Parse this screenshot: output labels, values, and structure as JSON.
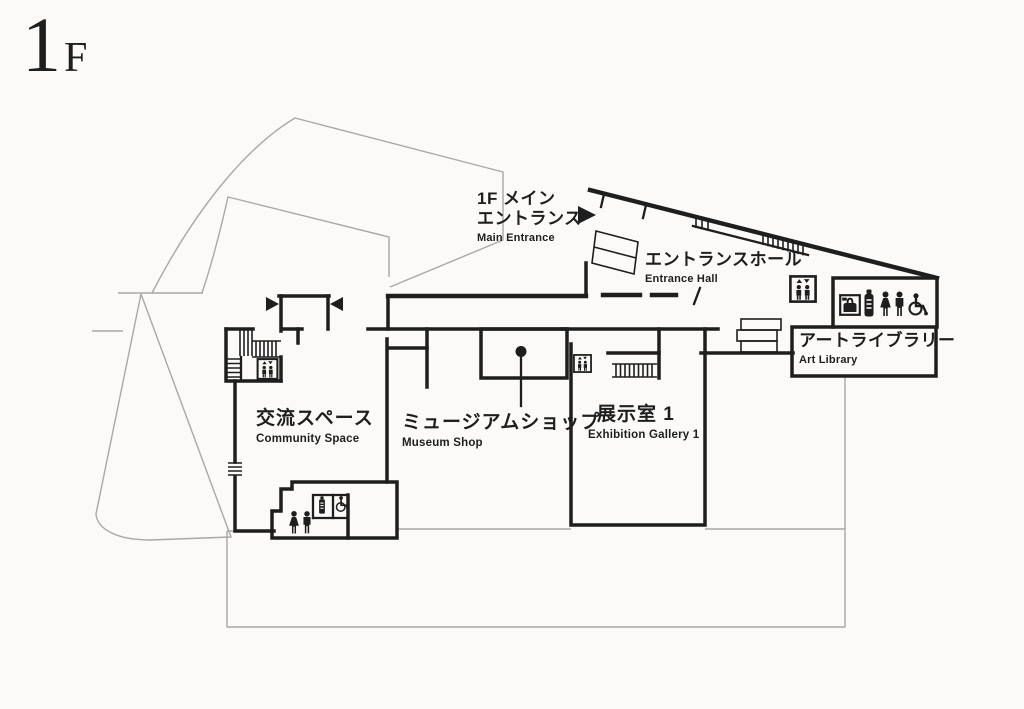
{
  "floor_label": {
    "big": "1",
    "small": "F"
  },
  "colors": {
    "wall": "#1e1e1e",
    "outline": "#a8a8a6",
    "background": "#fbfaf8",
    "text": "#1e1e1e"
  },
  "labels": {
    "main_entrance": {
      "jp1": "1F メイン",
      "jp2": "エントランス",
      "en": "Main Entrance"
    },
    "entrance_hall": {
      "jp": "エントランスホール",
      "en": "Entrance Hall"
    },
    "community_space": {
      "jp": "交流スペース",
      "en": "Community Space"
    },
    "museum_shop": {
      "jp": "ミュージアムショップ",
      "en": "Museum Shop"
    },
    "exhibition_gallery_1": {
      "jp": "展示室 1",
      "en": "Exhibition Gallery 1"
    },
    "art_library": {
      "jp": "アートライブラリー",
      "en": "Art Library"
    }
  },
  "icons": [
    "entrance-arrow-icon",
    "door-arrow-icon",
    "elevator-icon",
    "stairs-icon",
    "ramp-stairs-icon",
    "coin-locker-icon",
    "baby-bottle-icon",
    "womens-restroom-icon",
    "mens-restroom-icon",
    "accessible-restroom-icon",
    "museum-shop-marker-icon"
  ]
}
